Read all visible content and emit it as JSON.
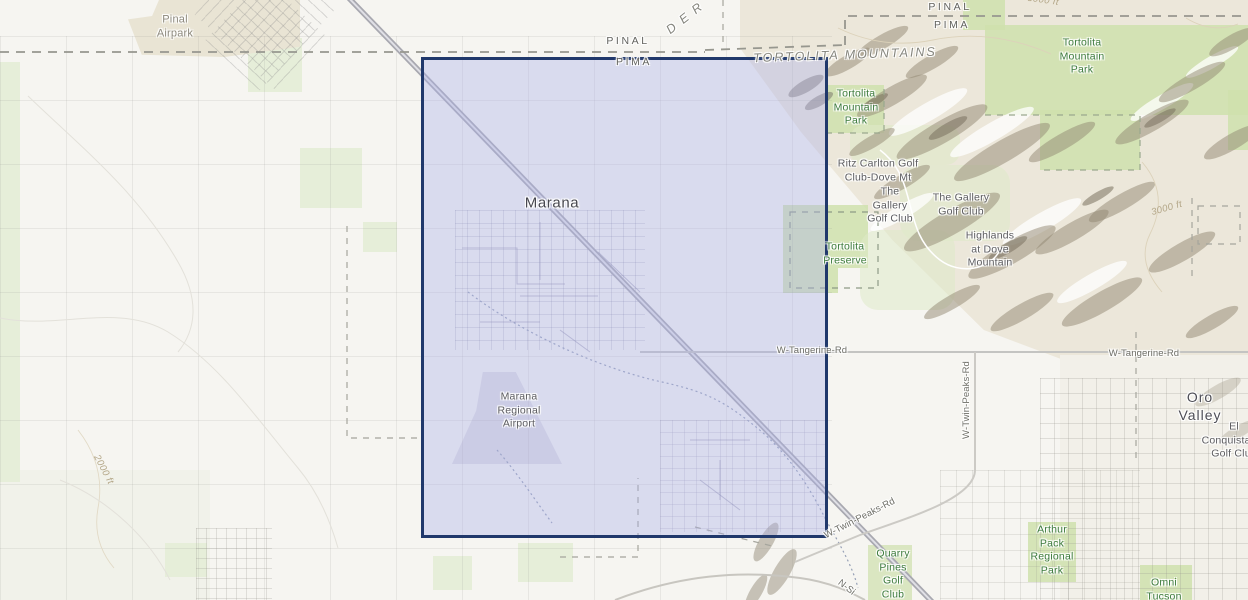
{
  "labels": {
    "pinal_airpark": {
      "text": "Pinal\nAirpark"
    },
    "county_pinal_left": {
      "text": "PINAL"
    },
    "county_pima_left": {
      "text": "PIMA"
    },
    "county_pinal_right": {
      "text": "PINAL"
    },
    "county_pima_right": {
      "text": "PIMA"
    },
    "der_partial": {
      "text": "D E R"
    },
    "tortolita_mountains": {
      "text": "TORTOLITA MOUNTAINS"
    },
    "tortolita_mtn_park_right": {
      "text": "Tortolita\nMountain\nPark"
    },
    "tortolita_mtn_park_left": {
      "text": "Tortolita\nMountain\nPark"
    },
    "marana": {
      "text": "Marana"
    },
    "ritz_carlton": {
      "text": "Ritz Carlton Golf\nClub-Dove Mt"
    },
    "gallery_golf_left": {
      "text": "The\nGallery\nGolf Club"
    },
    "gallery_golf_right": {
      "text": "The Gallery\nGolf Club"
    },
    "tortolita_preserve": {
      "text": "Tortolita\nPreserve"
    },
    "highlands_dove": {
      "text": "Highlands\nat Dove\nMountain"
    },
    "tangerine_left": {
      "text": "W-Tangerine-Rd"
    },
    "tangerine_right": {
      "text": "W-Tangerine-Rd"
    },
    "oro_valley": {
      "text": "Oro Valley"
    },
    "el_conquistador": {
      "text": "El Conquistador\nGolf Club"
    },
    "marana_airport": {
      "text": "Marana\nRegional\nAirport"
    },
    "twin_peaks_diagonal": {
      "text": "W-Twin-Peaks-Rd"
    },
    "twin_peaks_vertical": {
      "text": "W-Twin-Peaks-Rd"
    },
    "n_silverbell_partial": {
      "text": "N-Si"
    },
    "quarry_pines": {
      "text": "Quarry\nPines\nGolf\nClub"
    },
    "arthur_pack": {
      "text": "Arthur\nPack\nRegional\nPark"
    },
    "omni_tucson": {
      "text": "Omni\nTucson"
    },
    "contour_2000": {
      "text": "2000 ft"
    },
    "contour_3000": {
      "text": "3000 ft"
    },
    "contour_3000_top": {
      "text": "3000 ft"
    }
  },
  "colors": {
    "selection_fill": "#aab1e9",
    "selection_border": "#20386b",
    "park_green": "#cfe0ad",
    "farm_green": "#e6eed9",
    "terrain_tan": "#ece7da",
    "ridge_brown": "#92886f",
    "park_label_green": "#3c7a3c",
    "highway_gray": "#a8a8b0",
    "road_gray": "#c4c4c2",
    "county_dash_gray": "#97978f",
    "contour_tan": "#b3a687"
  }
}
